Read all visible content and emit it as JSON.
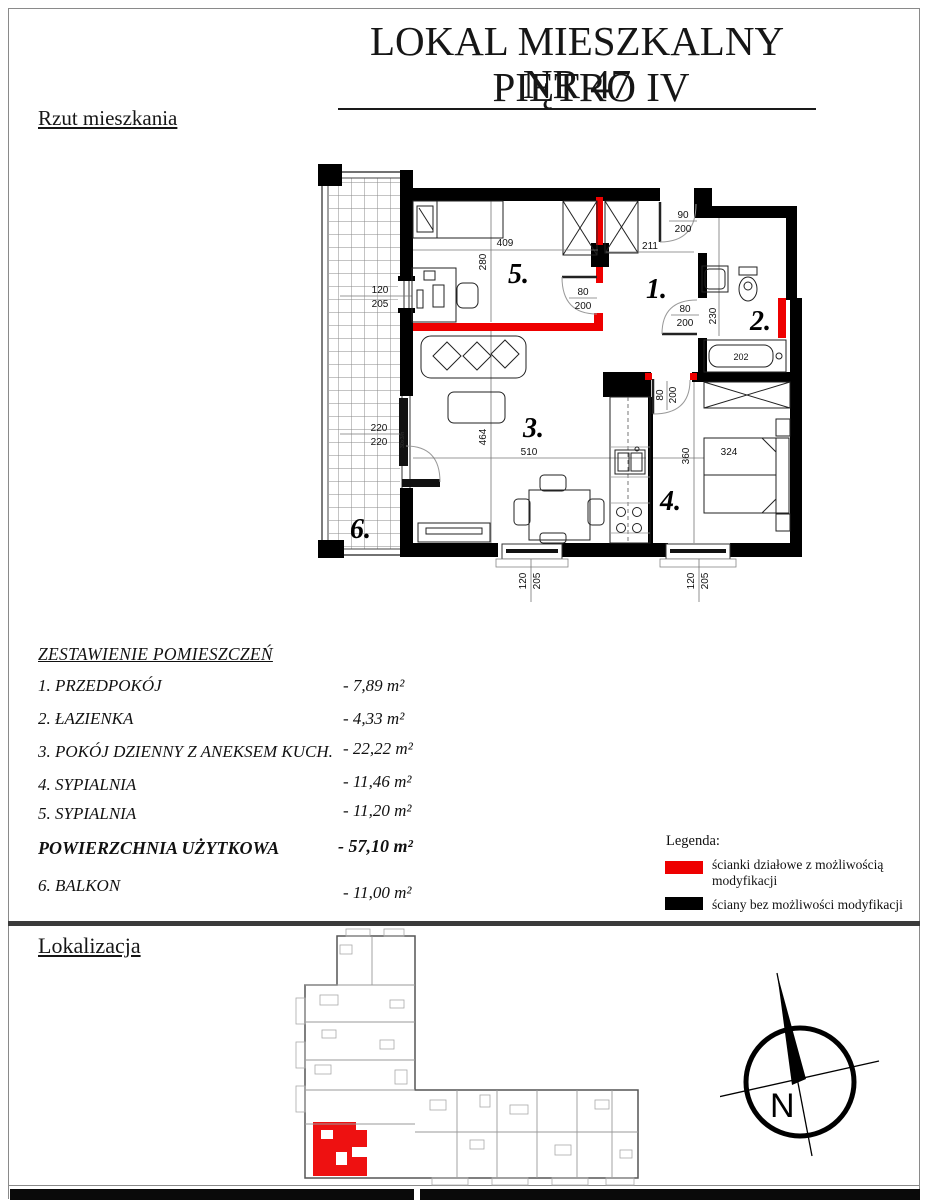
{
  "header": {
    "line1": "LOKAL MIESZKALNY NR 47",
    "line2": "PIĘTRO IV"
  },
  "sections": {
    "plan_title": "Rzut mieszkania",
    "list_title": "ZESTAWIENIE POMIESZCZEŃ",
    "location_title": "Lokalizacja"
  },
  "room_list": {
    "rows": [
      {
        "label": "1. PRZEDPOKÓJ",
        "value": "- 7,89 m²"
      },
      {
        "label": "2. ŁAZIENKA",
        "value": "- 4,33 m²"
      },
      {
        "label": "3. POKÓJ DZIENNY Z ANEKSEM KUCH.",
        "value": "- 22,22 m²"
      },
      {
        "label": "4. SYPIALNIA",
        "value": "- 11,46 m²"
      },
      {
        "label": "5. SYPIALNIA",
        "value": "- 11,20 m²"
      }
    ],
    "total": {
      "label": "POWIERZCHNIA UŻYTKOWA",
      "value": "- 57,10 m²"
    },
    "balcony": {
      "label": "6. BALKON",
      "value": "- 11,00 m²"
    }
  },
  "legend": {
    "title": "Legenda:",
    "items": [
      {
        "color": "#ee0000",
        "label": "ścianki działowe z możliwością modyfikacji"
      },
      {
        "color": "#000000",
        "label": "ściany bez możliwości modyfikacji"
      }
    ]
  },
  "plan": {
    "rooms": {
      "r1": "1.",
      "r2": "2.",
      "r3": "3.",
      "r4": "4.",
      "r5": "5.",
      "r6": "6."
    },
    "dims": {
      "w409": "409",
      "h280": "280",
      "w211": "211",
      "h230": "230",
      "tub": "202",
      "h464": "464",
      "w510": "510",
      "h360": "360",
      "w324": "324",
      "n90": "90",
      "n200": "200",
      "n80": "80",
      "n120": "120",
      "n205": "205",
      "n220": "220",
      "note": "30x3/h"
    }
  },
  "compass": {
    "label": "N"
  },
  "colors": {
    "wall_black": "#000000",
    "wall_red": "#ee0000",
    "unit_highlight": "#ee1111"
  }
}
